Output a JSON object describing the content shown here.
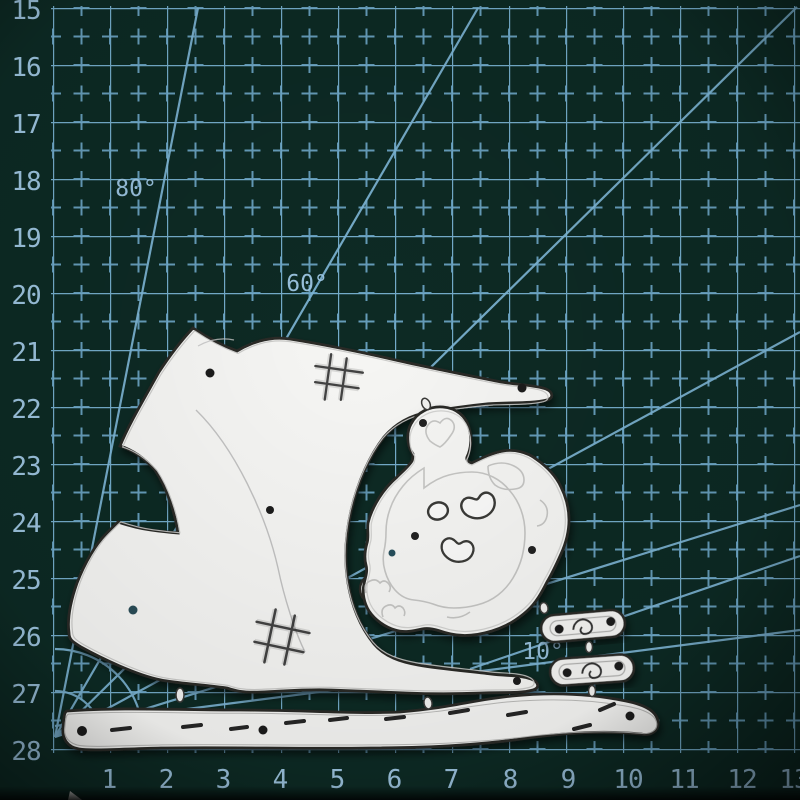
{
  "mat": {
    "background_color": "#0d2a24",
    "grid_color": "#79b3d3",
    "label_color": "#a3cbe7",
    "row_labels": [
      "15",
      "16",
      "17",
      "18",
      "19",
      "20",
      "21",
      "22",
      "23",
      "24",
      "25",
      "26",
      "27",
      "28"
    ],
    "col_labels": [
      "1",
      "2",
      "3",
      "4",
      "5",
      "6",
      "7",
      "8",
      "9",
      "10",
      "11",
      "12",
      "13"
    ],
    "angle_labels": [
      "80°",
      "60°",
      "10°"
    ]
  },
  "dies": {
    "material_color": "#f6f6f4",
    "edge_color": "#2a2a28",
    "pieces": [
      "rocking-toy-body",
      "fluffy-animal-head",
      "small-connector-1",
      "small-connector-2",
      "rocker-bar"
    ]
  }
}
